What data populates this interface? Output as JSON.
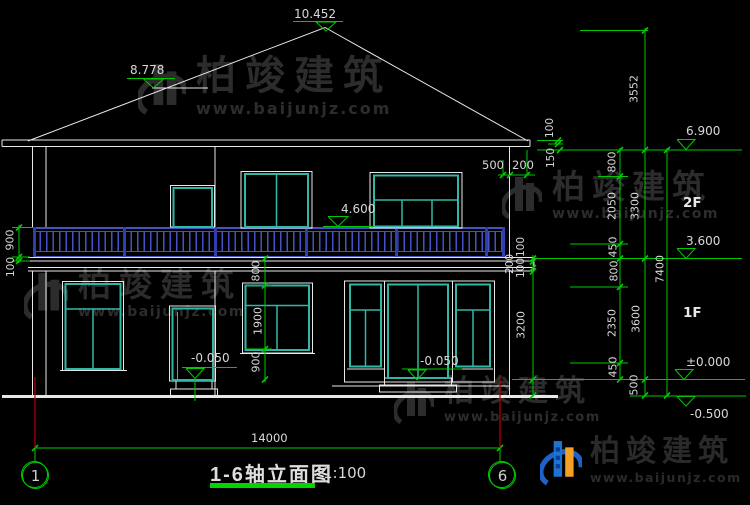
{
  "watermark": {
    "brand": "柏竣建筑",
    "url": "www.baijunjz.com"
  },
  "title_block": {
    "title": "1-6轴立面图",
    "scale": "1:100"
  },
  "axis": {
    "left_bubble": "1",
    "right_bubble": "6"
  },
  "floors": {
    "second": "2F",
    "first": "1F"
  },
  "levels": {
    "roof_peak": "10.452",
    "wing_ridge": "8.778",
    "eave": "6.900",
    "balcony_rail": "4.600",
    "floor_2": "3.600",
    "floor_1": "±0.000",
    "ground": "-0.500",
    "porch_left": "-0.050",
    "porch_right": "-0.050"
  },
  "dims": {
    "total_width": "14000",
    "left_balcony": [
      "900",
      "100"
    ],
    "window_left_chain": [
      "800",
      "1900",
      "900"
    ],
    "eave_overhang": [
      "500",
      "200"
    ],
    "eave_detail": [
      "100",
      "150"
    ],
    "balcony_edge_right": [
      "100",
      "200",
      "100"
    ],
    "story_right_lower": [
      "3200"
    ],
    "right_inner": [
      "800",
      "2050",
      "450",
      "800",
      "2350",
      "450"
    ],
    "right_middle": [
      "3552",
      "3300",
      "3600",
      "500"
    ],
    "right_outer": [
      "7400"
    ]
  }
}
